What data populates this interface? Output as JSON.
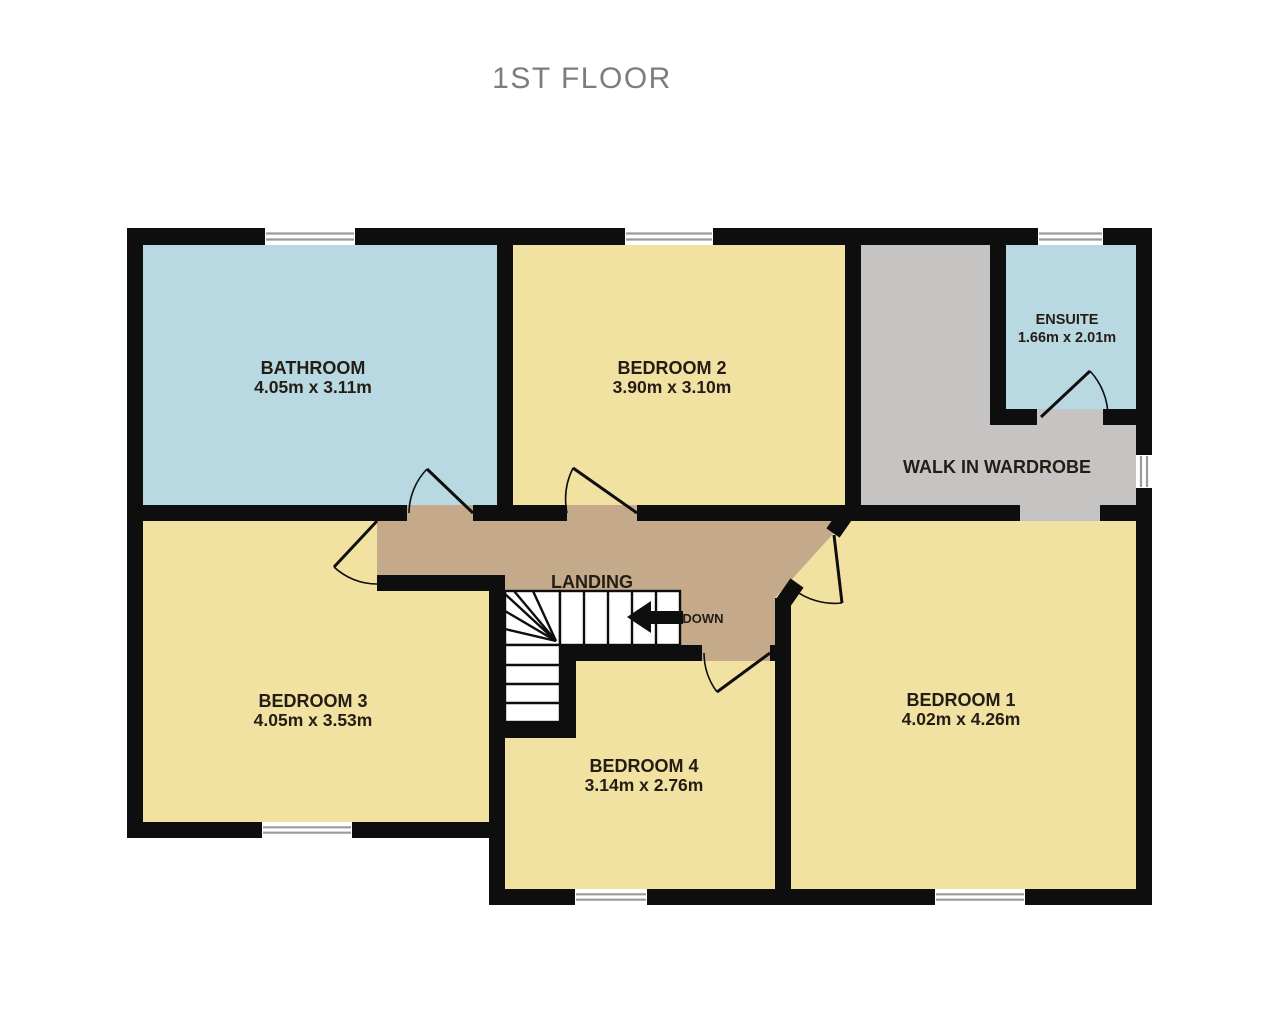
{
  "title": "1ST FLOOR",
  "colors": {
    "wall": "#0e0e0e",
    "room_yellow": "#f2e2a2",
    "room_blue": "#b9d9e2",
    "room_gray": "#c5c4c3",
    "landing_tan": "#c5a98b",
    "title_gray": "#7d7d7d",
    "label_text": "#231d15",
    "window_line": "#9a9a9a"
  },
  "rooms": [
    {
      "id": "bathroom",
      "name": "BATHROOM",
      "dims": "4.05m  x 3.11m"
    },
    {
      "id": "bedroom2",
      "name": "BEDROOM 2",
      "dims": "3.90m  x 3.10m"
    },
    {
      "id": "ensuite",
      "name": "ENSUITE",
      "dims": "1.66m  x 2.01m"
    },
    {
      "id": "wardrobe",
      "name": "WALK IN WARDROBE",
      "dims": ""
    },
    {
      "id": "landing",
      "name": "LANDING",
      "dims": ""
    },
    {
      "id": "bedroom3",
      "name": "BEDROOM 3",
      "dims": "4.05m  x 3.53m"
    },
    {
      "id": "bedroom4",
      "name": "BEDROOM 4",
      "dims": "3.14m  x 2.76m"
    },
    {
      "id": "bedroom1",
      "name": "BEDROOM 1",
      "dims": "4.02m  x 4.26m"
    }
  ],
  "stairs": {
    "down_label": "DOWN"
  }
}
